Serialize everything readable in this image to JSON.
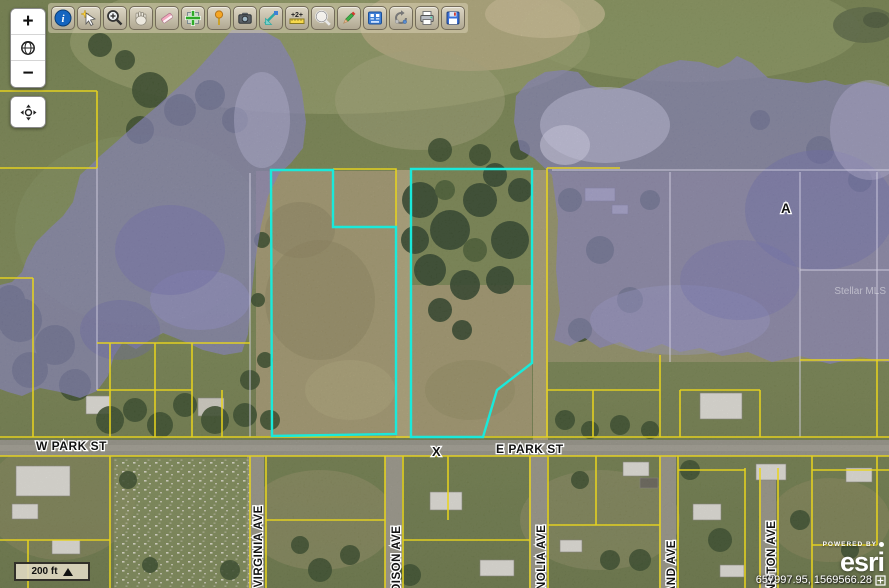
{
  "toolbar": {
    "tools": [
      "identify",
      "select-features",
      "zoom-in-tool",
      "pan-tool",
      "eraser-tool",
      "add-to-map",
      "pushpin-tool",
      "snapshot-tool",
      "sketch-tools",
      "measure-tool",
      "find-tool",
      "draw-tool",
      "attribute-table",
      "refresh-tool",
      "print-tool",
      "save-tool"
    ]
  },
  "nav": {
    "zoom_in": "+",
    "zoom_out": "−"
  },
  "scalebar": {
    "label": "200 ft"
  },
  "statusbar": {
    "coordinates": "657997.95, 1569566.28"
  },
  "attribution": {
    "powered_by": "POWERED BY",
    "brand": "esri"
  },
  "map": {
    "labels": {
      "w_park_st": "W PARK ST",
      "e_park_st": "E PARK ST",
      "x_marker": "X",
      "zone_a": "A",
      "virginia_ave": "N VIRGINIA AVE",
      "madison_ave": "DISON AVE",
      "magnolia_ave": "NOLIA AVE",
      "and_ave": "AND AVE",
      "ngton_ave": "NGTON AVE",
      "watermark": "Stellar MLS"
    },
    "colors": {
      "flood_zone": "#8b88c7",
      "parcel_line": "#e8d41e",
      "highlight": "#1ae9da"
    }
  }
}
